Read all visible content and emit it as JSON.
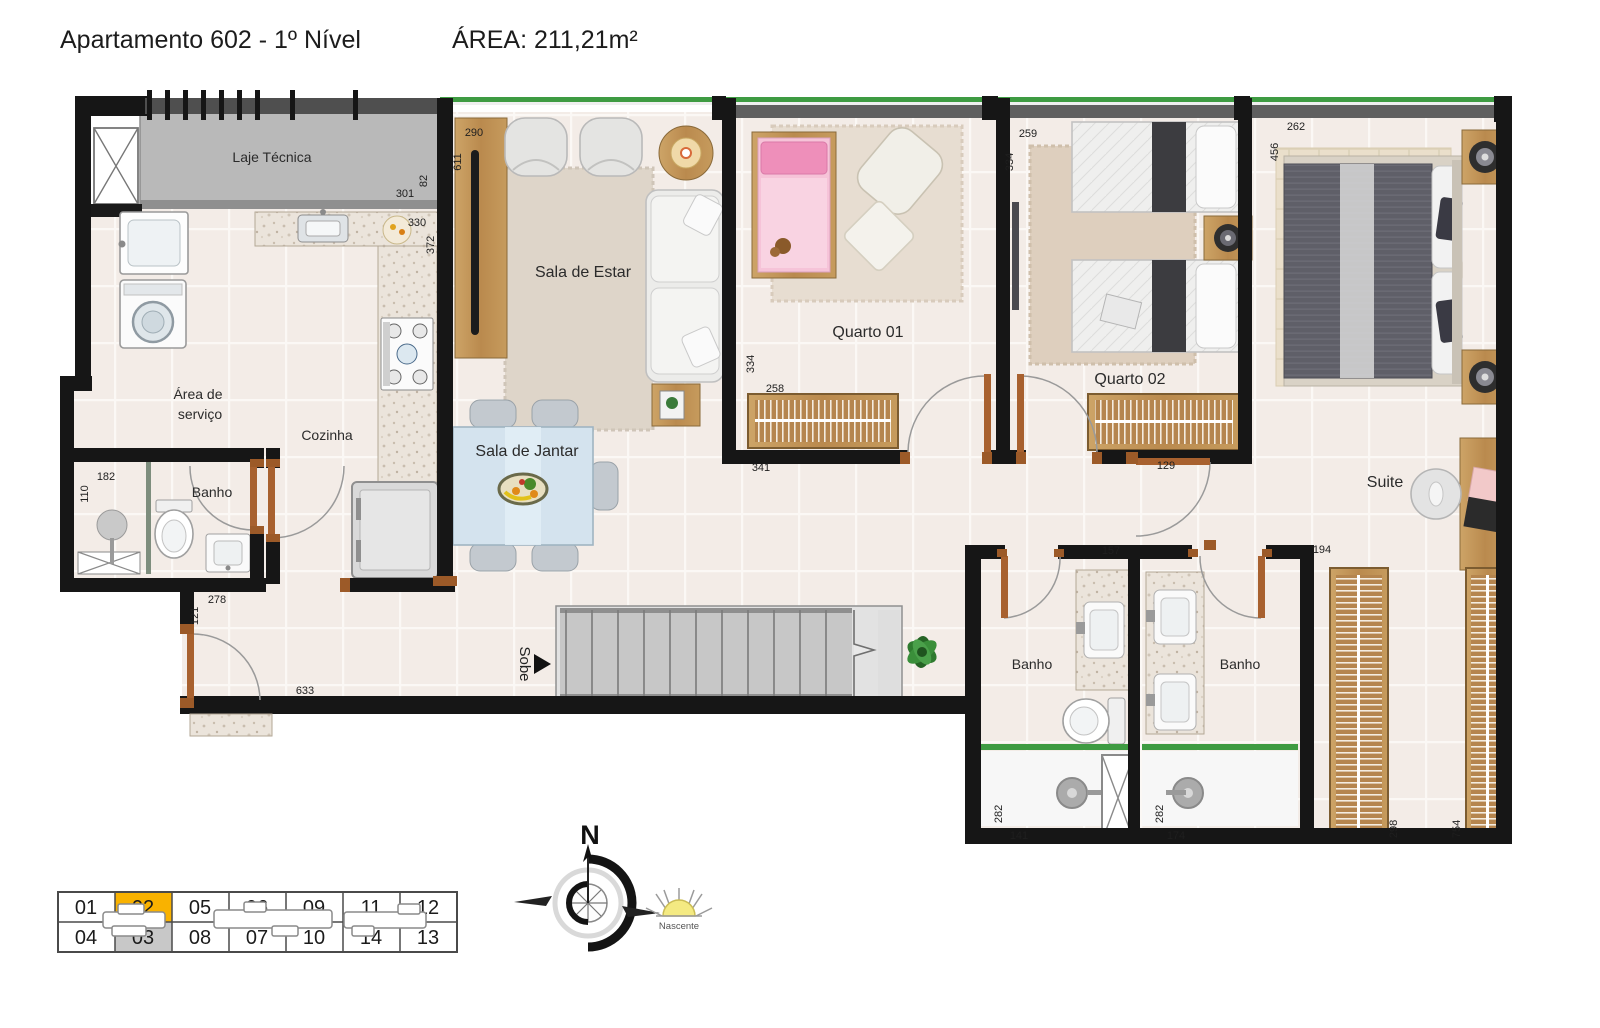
{
  "header": {
    "title": "Apartamento 602 - 1º Nível",
    "area": "ÁREA: 211,21m²"
  },
  "rooms": {
    "laje_tecnica": "Laje Técnica",
    "sala_de_estar": "Sala de Estar",
    "area_de_servico_line1": "Área de",
    "area_de_servico_line2": "serviço",
    "cozinha": "Cozinha",
    "banho_social": "Banho",
    "sala_de_jantar": "Sala de Jantar",
    "quarto_01": "Quarto 01",
    "quarto_02": "Quarto 02",
    "suite": "Suite",
    "banho_1": "Banho",
    "banho_2": "Banho",
    "stairs_label": "Sobe"
  },
  "dimensions": {
    "sala_width": "290",
    "sala_depth": "611",
    "laje_width": "301",
    "laje_height": "82",
    "kitchen_width": "330",
    "kitchen_depth": "372",
    "q2_width": "259",
    "q2_depth": "334",
    "suite_depth": "456",
    "suite_width": "262",
    "q1_depth": "334",
    "q1_wardrobe": "258",
    "q1_width": "341",
    "q2_door": "129",
    "banho_social_width": "182",
    "banho_social_depth": "110",
    "entry_width": "278",
    "entry_door": "121",
    "hall_length": "633",
    "banho1_width": "157",
    "closet_hall_width": "194",
    "shower1_depth": "282",
    "shower1_width": "141",
    "shower2_depth": "282",
    "shower2_width": "174",
    "closet1_length": "298",
    "closet2_length": "754"
  },
  "compass": {
    "north": "N",
    "east": "Nascente"
  },
  "unit_map": {
    "row1": [
      "01",
      "02",
      "05",
      "06",
      "09",
      "11",
      "12"
    ],
    "row2": [
      "04",
      "03",
      "08",
      "07",
      "10",
      "14",
      "13"
    ],
    "highlighted": "02",
    "secondary": "03"
  },
  "colors": {
    "highlight": "#F9B200",
    "secondary": "#C8C8C8",
    "window_green": "#3E9B42",
    "wall": "#161616",
    "wood": "#C49A62"
  }
}
